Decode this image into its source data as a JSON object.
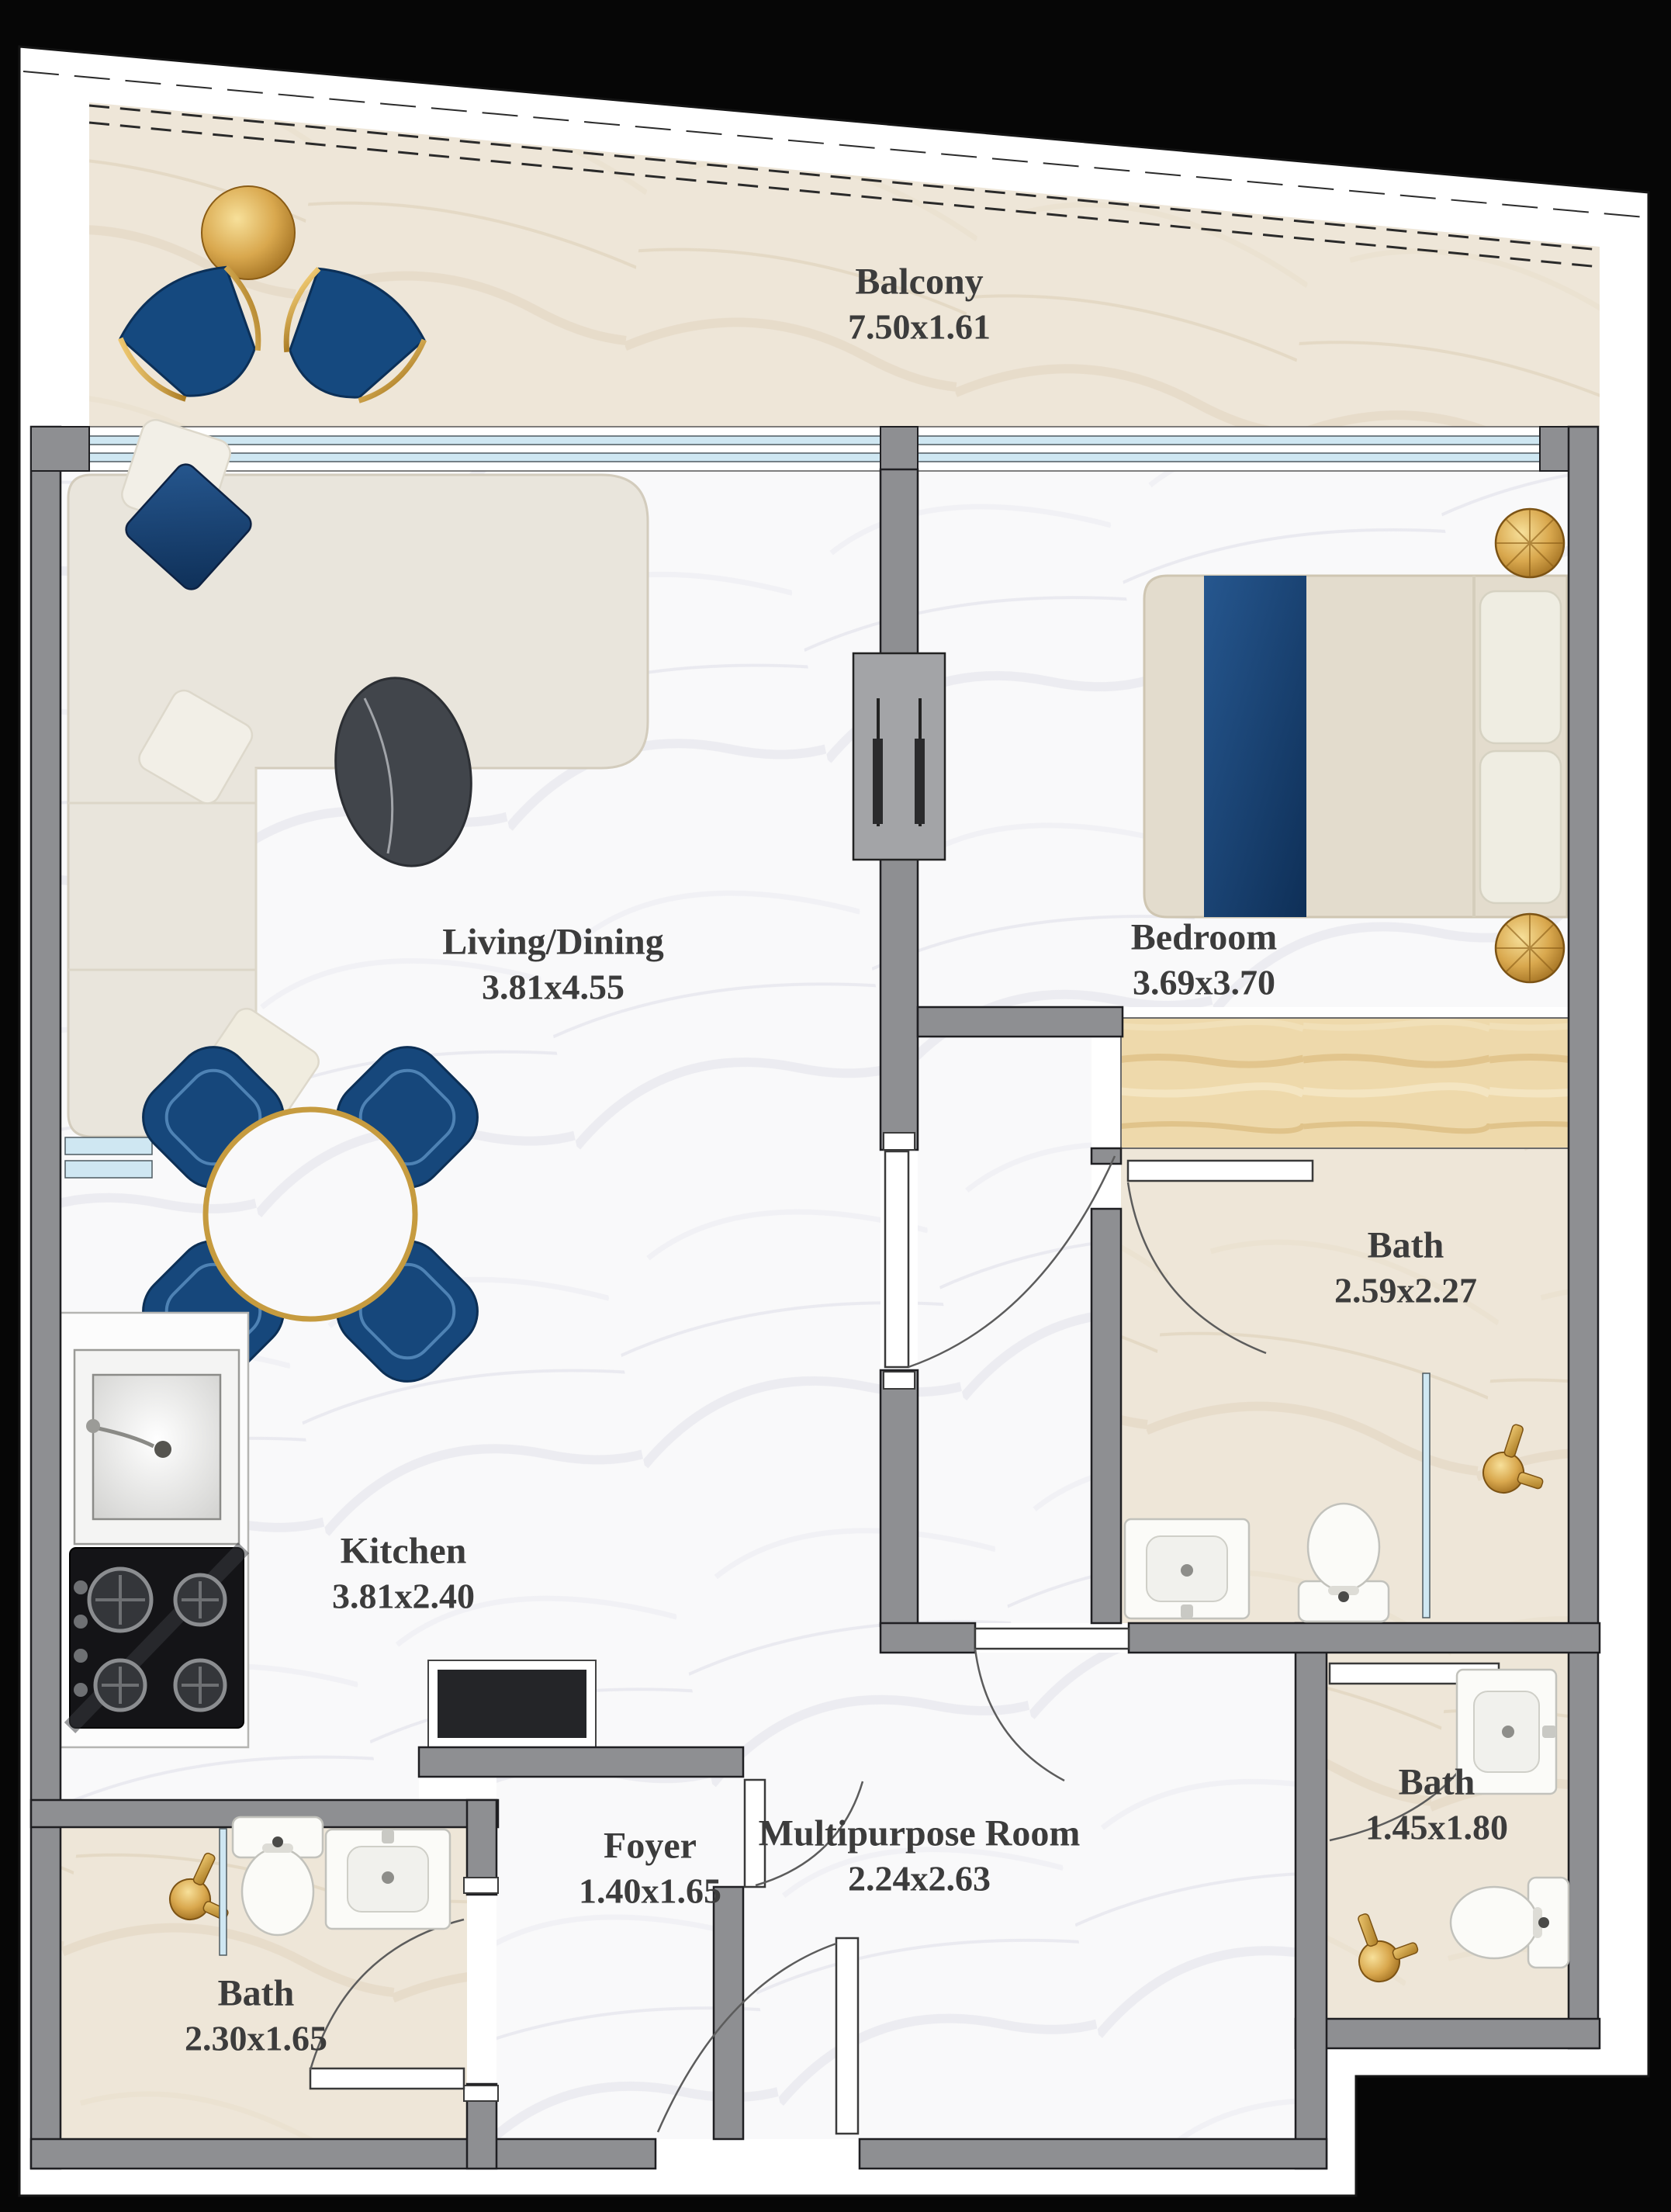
{
  "plan": {
    "rooms": {
      "balcony": {
        "name": "Balcony",
        "dims": "7.50x1.61"
      },
      "living_dining": {
        "name": "Living/Dining",
        "dims": "3.81x4.55"
      },
      "bedroom": {
        "name": "Bedroom",
        "dims": "3.69x3.70"
      },
      "kitchen": {
        "name": "Kitchen",
        "dims": "3.81x2.40"
      },
      "bath_ensuite": {
        "name": "Bath",
        "dims": "2.59x2.27"
      },
      "bath_guest": {
        "name": "Bath",
        "dims": "1.45x1.80"
      },
      "bath_lower": {
        "name": "Bath",
        "dims": "2.30x1.65"
      },
      "foyer": {
        "name": "Foyer",
        "dims": "1.40x1.65"
      },
      "multipurpose": {
        "name": "Multipurpose Room",
        "dims": "2.24x2.63"
      }
    },
    "colors": {
      "background": "#060606",
      "sheet": "#ffffff",
      "wall_gray": "#8e8f92",
      "marble_white": "#f9f9fa",
      "marble_beige": "#eee6d8",
      "wood": "#eed9ab",
      "navy_accent": "#16477b",
      "gold_accent": "#d9a84e",
      "glass_blue": "#cfe7f2",
      "label_text": "#3c3c3c"
    }
  }
}
